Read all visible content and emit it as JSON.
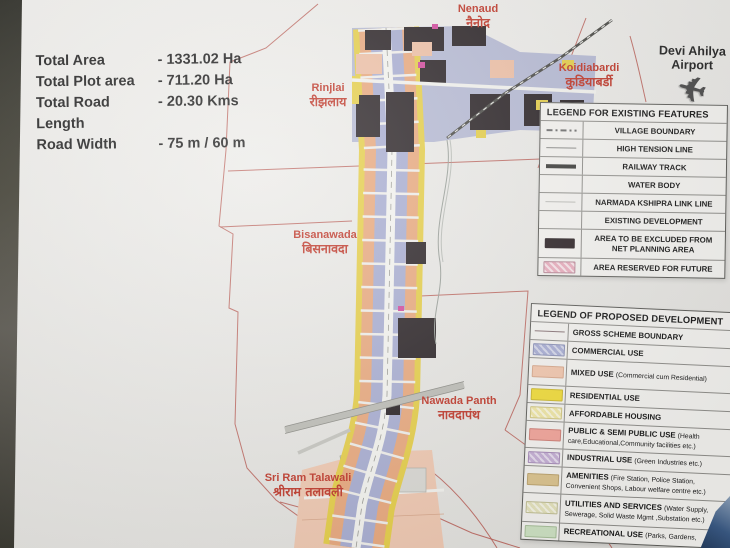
{
  "board": {
    "type": "town planning scheme display board",
    "stats": {
      "rows": [
        {
          "label": "Total Area",
          "value": "- 1331.02 Ha"
        },
        {
          "label": "Total Plot area",
          "value": "- 711.20 Ha"
        },
        {
          "label": "Total Road Length",
          "value": "- 20.30 Kms"
        },
        {
          "label": "Road Width",
          "value": "- 75 m / 60 m"
        }
      ]
    }
  },
  "airport": {
    "line1": "Devi Ahilya",
    "line2": "Airport",
    "icon": "airplane-icon",
    "plane_glyph": "✈"
  },
  "places": [
    {
      "en": "Nenaud",
      "hi": "नैनोद"
    },
    {
      "en": "Koidiabardi",
      "hi": "कुडियाबर्डी"
    },
    {
      "en": "Rinjlai",
      "hi": "रीझलाय"
    },
    {
      "en": "Bisanawada",
      "hi": "बिसनावदा"
    },
    {
      "en": "Nawada Panth",
      "hi": "नावदापंथ"
    },
    {
      "en": "Sri Ram Talawali",
      "hi": "श्रीराम तलावली"
    }
  ],
  "legend_existing": {
    "title": "LEGEND FOR EXISTING FEATURES",
    "items": [
      {
        "label": "VILLAGE BOUNDARY",
        "swatch": "dash-dot-line"
      },
      {
        "label": "HIGH TENSION LINE",
        "swatch": "thin-line"
      },
      {
        "label": "RAILWAY TRACK",
        "swatch": "thick-line"
      },
      {
        "label": "WATER BODY",
        "swatch": "none"
      },
      {
        "label": "NARMADA KSHIPRA LINK LINE",
        "swatch": "light-line"
      },
      {
        "label": "EXISTING DEVELOPMENT",
        "swatch": "none"
      },
      {
        "label": "AREA TO BE EXCLUDED FROM NET PLANNING AREA",
        "swatch": "dark-fill"
      },
      {
        "label": "AREA RESERVED FOR FUTURE",
        "swatch": "pink-hatch"
      }
    ]
  },
  "legend_proposed": {
    "title": "LEGEND OF PROPOSED DEVELOPMENT",
    "items": [
      {
        "label": "GROSS SCHEME BOUNDARY",
        "swatch": "boundary-line"
      },
      {
        "label": "COMMERCIAL USE",
        "swatch": "blue-hatch"
      },
      {
        "label": "MIXED USE",
        "sub": "(Commercial cum Residential)",
        "swatch": "salmon-fill"
      },
      {
        "label": "RESIDENTIAL USE",
        "swatch": "yellow-fill"
      },
      {
        "label": "AFFORDABLE HOUSING",
        "swatch": "pale-yellow-hatch"
      },
      {
        "label": "PUBLIC & SEMI PUBLIC USE",
        "sub": "(Health care,Educational,Community facilities etc.)",
        "swatch": "red-fill"
      },
      {
        "label": "INDUSTRIAL USE",
        "sub": "(Green Industries etc.)",
        "swatch": "purple-hatch"
      },
      {
        "label": "AMENITIES",
        "sub": "(Fire Station, Police Station, Convenient Shops, Labour welfare centre etc.)",
        "swatch": "tan-fill"
      },
      {
        "label": "UTILITIES AND SERVICES",
        "sub": "(Water Supply, Sewerage, Solid Waste Mgmt ,Substation etc.)",
        "swatch": "pale-green-hatch"
      },
      {
        "label": "RECREATIONAL USE",
        "sub": "(Parks, Gardens,",
        "swatch": "green-fill"
      }
    ]
  },
  "colors": {
    "label_red": "#c0392b",
    "boundary_line_red": "#b85a52",
    "commercial": "#a9aed4",
    "mixed_use": "#f2c7ae",
    "residential": "#f1dc3a",
    "affordable_housing": "#f0e7a6",
    "public_semi_public": "#f2a49a",
    "industrial": "#c5afd5",
    "amenities": "#dcc48e",
    "utilities_services": "#e5e3bd",
    "recreational": "#cfe3c4",
    "excluded_area": "#2d2427",
    "reserved_future": "#e9aebe",
    "board_background": "#eae9e6"
  }
}
